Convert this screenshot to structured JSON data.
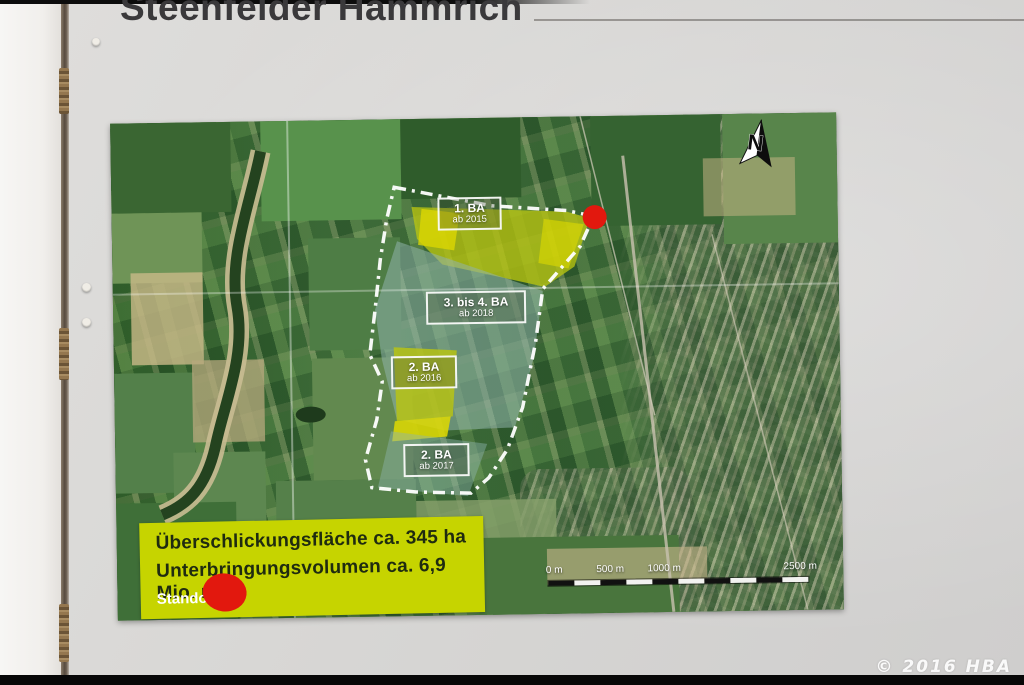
{
  "board": {
    "title": "Steenfelder Hammrich",
    "watermark": "© 2016 HBA"
  },
  "map": {
    "north_label": "N",
    "zones": [
      {
        "label": "1. BA",
        "sublabel": "ab 2015"
      },
      {
        "label": "3. bis 4. BA",
        "sublabel": "ab 2018"
      },
      {
        "label": "2. BA",
        "sublabel": "ab 2016"
      },
      {
        "label": "2. BA",
        "sublabel": "ab 2017"
      }
    ],
    "scale_ticks": [
      "0 m",
      "500 m",
      "1000 m",
      "2500 m"
    ],
    "colors": {
      "zone_yellow": "#b9c411",
      "zone_teal": "#8fb3ac",
      "boundary": "#ffffff",
      "standort_red": "#e2180e"
    }
  },
  "legend": {
    "line1": "Überschlickungsfläche ca. 345 ha",
    "line2": "Unterbringungsvolumen ca. 6,9 Mio. m³",
    "standort_label": "Standort",
    "bg": "#c6d400"
  }
}
